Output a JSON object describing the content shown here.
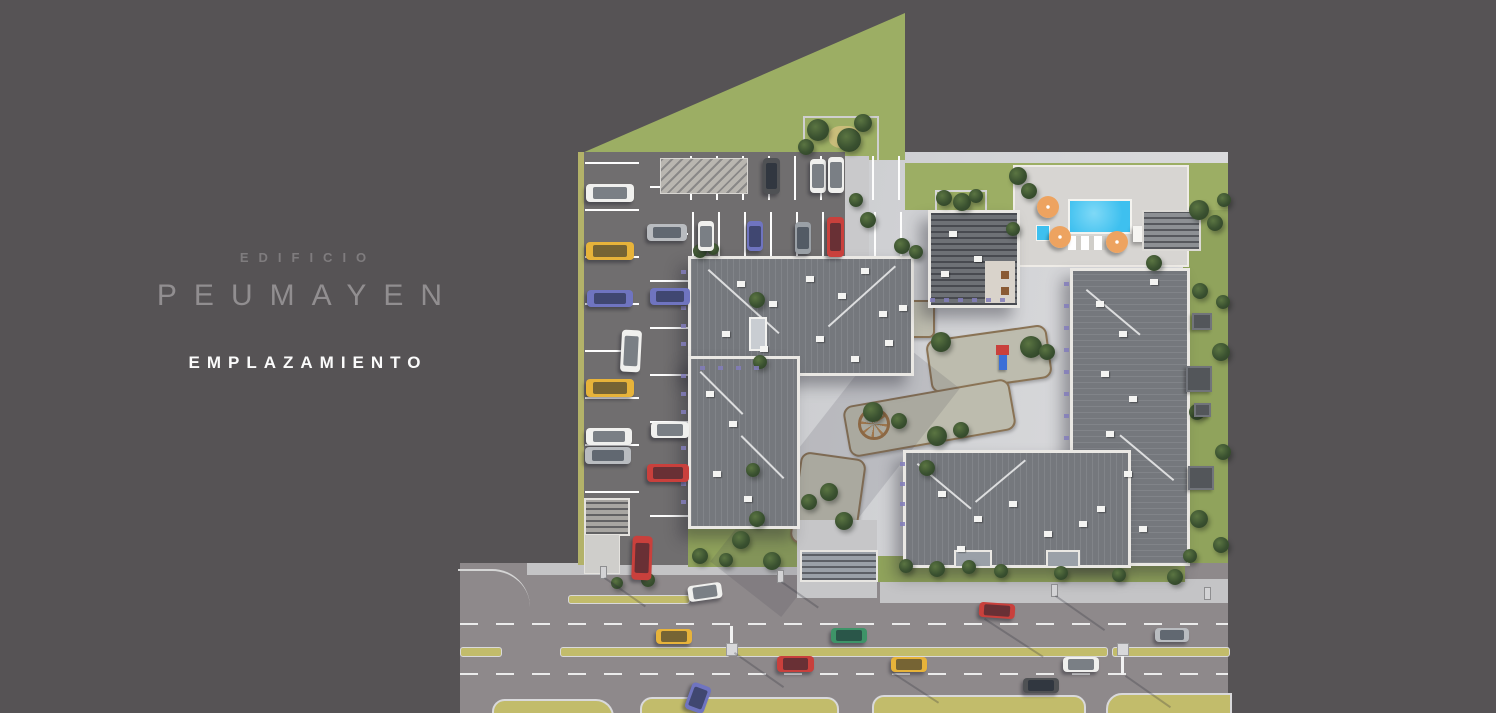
{
  "meta": {
    "brand_label": "EDIFICIO",
    "brand_name": "PEUMAYEN",
    "view_label": "EMPLAZAMIENTO"
  },
  "colors": {
    "background": "#565355",
    "title_gray": "#918e90",
    "subtitle_white": "#fbfbfb",
    "grass": "#9cae64",
    "parking_asphalt": "#706e6f",
    "street_asphalt": "#8e898b",
    "plaza_paving": "#cccdd0",
    "roof": "#75787d",
    "pool_blue": "#3ec0ef",
    "umbrella_orange": "#eda360",
    "median_yellow": "#c2bc6b",
    "cars": {
      "white": "#f0f0ee",
      "yellow": "#e7b33a",
      "red": "#c9403c",
      "green": "#3e9468",
      "blue": "#6f74c0",
      "silver": "#b9bcc0",
      "dark": "#4f5154",
      "gray": "#9aa0a6"
    }
  },
  "site": {
    "trees": [
      [
        818,
        130,
        11
      ],
      [
        849,
        140,
        12
      ],
      [
        863,
        123,
        9
      ],
      [
        806,
        147,
        8
      ],
      [
        868,
        220,
        8
      ],
      [
        856,
        200,
        7
      ],
      [
        944,
        198,
        8
      ],
      [
        962,
        202,
        9
      ],
      [
        976,
        196,
        7
      ],
      [
        1018,
        176,
        9
      ],
      [
        1029,
        191,
        8
      ],
      [
        1013,
        229,
        7
      ],
      [
        1154,
        263,
        8
      ],
      [
        1199,
        210,
        10
      ],
      [
        1215,
        223,
        8
      ],
      [
        1224,
        200,
        7
      ],
      [
        1200,
        291,
        8
      ],
      [
        1223,
        302,
        7
      ],
      [
        1221,
        352,
        9
      ],
      [
        1197,
        412,
        8
      ],
      [
        1223,
        452,
        8
      ],
      [
        1199,
        519,
        9
      ],
      [
        1221,
        545,
        8
      ],
      [
        1190,
        556,
        7
      ],
      [
        941,
        342,
        10
      ],
      [
        1031,
        347,
        11
      ],
      [
        1047,
        352,
        8
      ],
      [
        873,
        412,
        10
      ],
      [
        899,
        421,
        8
      ],
      [
        937,
        436,
        10
      ],
      [
        961,
        430,
        8
      ],
      [
        829,
        492,
        9
      ],
      [
        809,
        502,
        8
      ],
      [
        844,
        521,
        9
      ],
      [
        927,
        468,
        8
      ],
      [
        757,
        300,
        8
      ],
      [
        760,
        362,
        7
      ],
      [
        753,
        470,
        7
      ],
      [
        757,
        519,
        8
      ],
      [
        741,
        540,
        9
      ],
      [
        700,
        556,
        8
      ],
      [
        726,
        560,
        7
      ],
      [
        772,
        561,
        9
      ],
      [
        906,
        566,
        7
      ],
      [
        937,
        569,
        8
      ],
      [
        969,
        567,
        7
      ],
      [
        1001,
        571,
        7
      ],
      [
        1061,
        573,
        7
      ],
      [
        1119,
        575,
        7
      ],
      [
        1175,
        577,
        8
      ],
      [
        648,
        580,
        7
      ],
      [
        617,
        583,
        6
      ],
      [
        700,
        251,
        7
      ],
      [
        713,
        249,
        6
      ],
      [
        902,
        246,
        8
      ],
      [
        916,
        252,
        7
      ]
    ],
    "cars": [
      [
        586,
        184,
        48,
        18,
        "white",
        0
      ],
      [
        586,
        242,
        48,
        18,
        "yellow",
        0
      ],
      [
        587,
        290,
        46,
        17,
        "blue",
        0
      ],
      [
        586,
        379,
        48,
        18,
        "yellow",
        0
      ],
      [
        586,
        428,
        46,
        17,
        "white",
        0
      ],
      [
        585,
        447,
        46,
        17,
        "silver",
        0
      ],
      [
        647,
        224,
        40,
        17,
        "silver",
        0
      ],
      [
        650,
        288,
        40,
        17,
        "blue",
        0
      ],
      [
        651,
        422,
        38,
        16,
        "white",
        0
      ],
      [
        647,
        464,
        42,
        18,
        "red",
        0
      ],
      [
        763,
        158,
        17,
        36,
        "dark",
        0
      ],
      [
        810,
        159,
        16,
        34,
        "white",
        0
      ],
      [
        828,
        157,
        16,
        36,
        "white",
        0
      ],
      [
        698,
        221,
        16,
        30,
        "white",
        0
      ],
      [
        747,
        221,
        16,
        30,
        "blue",
        0
      ],
      [
        795,
        222,
        16,
        32,
        "gray",
        0
      ],
      [
        827,
        217,
        17,
        40,
        "red",
        0
      ],
      [
        621,
        330,
        20,
        42,
        "white",
        3
      ],
      [
        632,
        536,
        20,
        44,
        "red",
        2
      ],
      [
        688,
        584,
        34,
        16,
        "white",
        -8
      ],
      [
        656,
        629,
        36,
        15,
        "yellow",
        0
      ],
      [
        831,
        628,
        36,
        15,
        "green",
        0
      ],
      [
        777,
        656,
        37,
        16,
        "red",
        0
      ],
      [
        891,
        657,
        36,
        15,
        "yellow",
        0
      ],
      [
        979,
        603,
        36,
        15,
        "red",
        4
      ],
      [
        1155,
        628,
        34,
        14,
        "silver",
        0
      ],
      [
        1063,
        657,
        36,
        15,
        "white",
        0
      ],
      [
        1023,
        678,
        36,
        15,
        "dark",
        0
      ],
      [
        688,
        684,
        20,
        28,
        "blue",
        20
      ]
    ],
    "roof_vents": [
      [
        737,
        281
      ],
      [
        769,
        301
      ],
      [
        806,
        276
      ],
      [
        838,
        293
      ],
      [
        861,
        268
      ],
      [
        879,
        311
      ],
      [
        722,
        331
      ],
      [
        760,
        346
      ],
      [
        816,
        336
      ],
      [
        851,
        356
      ],
      [
        706,
        391
      ],
      [
        729,
        421
      ],
      [
        713,
        471
      ],
      [
        744,
        496
      ],
      [
        938,
        491
      ],
      [
        974,
        516
      ],
      [
        1009,
        501
      ],
      [
        1044,
        531
      ],
      [
        1079,
        521
      ],
      [
        957,
        546
      ],
      [
        1096,
        301
      ],
      [
        1119,
        331
      ],
      [
        1101,
        371
      ],
      [
        1129,
        396
      ],
      [
        1106,
        431
      ],
      [
        1124,
        471
      ],
      [
        1097,
        506
      ],
      [
        1139,
        526
      ],
      [
        1150,
        279
      ],
      [
        949,
        231
      ],
      [
        974,
        256
      ],
      [
        941,
        271
      ],
      [
        899,
        305
      ],
      [
        885,
        340
      ]
    ],
    "umbrellas": [
      [
        1048,
        207
      ],
      [
        1060,
        237
      ],
      [
        1117,
        242
      ]
    ],
    "lawn_pergolas": [
      [
        1192,
        313,
        16,
        13
      ],
      [
        1186,
        366,
        22,
        22
      ],
      [
        1194,
        403,
        13,
        10
      ],
      [
        1188,
        466,
        22,
        20
      ]
    ],
    "balconies": [
      [
        681,
        270
      ],
      [
        681,
        288
      ],
      [
        681,
        306
      ],
      [
        681,
        324
      ],
      [
        681,
        342
      ],
      [
        681,
        374
      ],
      [
        681,
        392
      ],
      [
        681,
        410
      ],
      [
        681,
        428
      ],
      [
        681,
        446
      ],
      [
        681,
        464
      ],
      [
        681,
        482
      ],
      [
        681,
        500
      ],
      [
        1064,
        282
      ],
      [
        1064,
        304
      ],
      [
        1064,
        326
      ],
      [
        1064,
        348
      ],
      [
        1064,
        370
      ],
      [
        1064,
        392
      ],
      [
        1064,
        414
      ],
      [
        1064,
        436
      ],
      [
        700,
        366
      ],
      [
        718,
        366
      ],
      [
        736,
        366
      ],
      [
        754,
        366
      ],
      [
        930,
        298
      ],
      [
        944,
        298
      ],
      [
        958,
        298
      ],
      [
        972,
        298
      ],
      [
        986,
        298
      ],
      [
        1000,
        298
      ],
      [
        900,
        462
      ],
      [
        900,
        482
      ],
      [
        900,
        502
      ],
      [
        900,
        522
      ]
    ],
    "street": {
      "medians": [
        [
          568,
          595,
          120,
          7
        ],
        [
          460,
          647,
          40,
          8
        ],
        [
          560,
          647,
          168,
          8
        ],
        [
          736,
          647,
          370,
          8
        ],
        [
          1112,
          647,
          116,
          8
        ]
      ],
      "median_posts": [
        [
          730,
          626,
          3,
          26
        ],
        [
          1121,
          649,
          3,
          26
        ]
      ],
      "median_boxes": [
        [
          726,
          643,
          10,
          11
        ],
        [
          1117,
          643,
          10,
          11
        ]
      ],
      "street_lights": [
        [
          600,
          566,
          5,
          11
        ],
        [
          777,
          570,
          5,
          11
        ],
        [
          1051,
          584,
          5,
          11
        ],
        [
          1204,
          587,
          5,
          11
        ]
      ],
      "islands": [
        [
          492,
          699,
          118,
          14
        ],
        [
          640,
          697,
          195,
          16
        ],
        [
          872,
          695,
          210,
          18
        ],
        [
          1106,
          693,
          122,
          20
        ]
      ],
      "shadow_lines": [
        [
          735,
          652,
          60,
          35
        ],
        [
          1126,
          675,
          55,
          35
        ],
        [
          605,
          577,
          50,
          35
        ],
        [
          1056,
          595,
          60,
          35
        ],
        [
          782,
          581,
          45,
          35
        ],
        [
          985,
          618,
          70,
          33
        ],
        [
          893,
          672,
          55,
          33
        ]
      ]
    }
  }
}
